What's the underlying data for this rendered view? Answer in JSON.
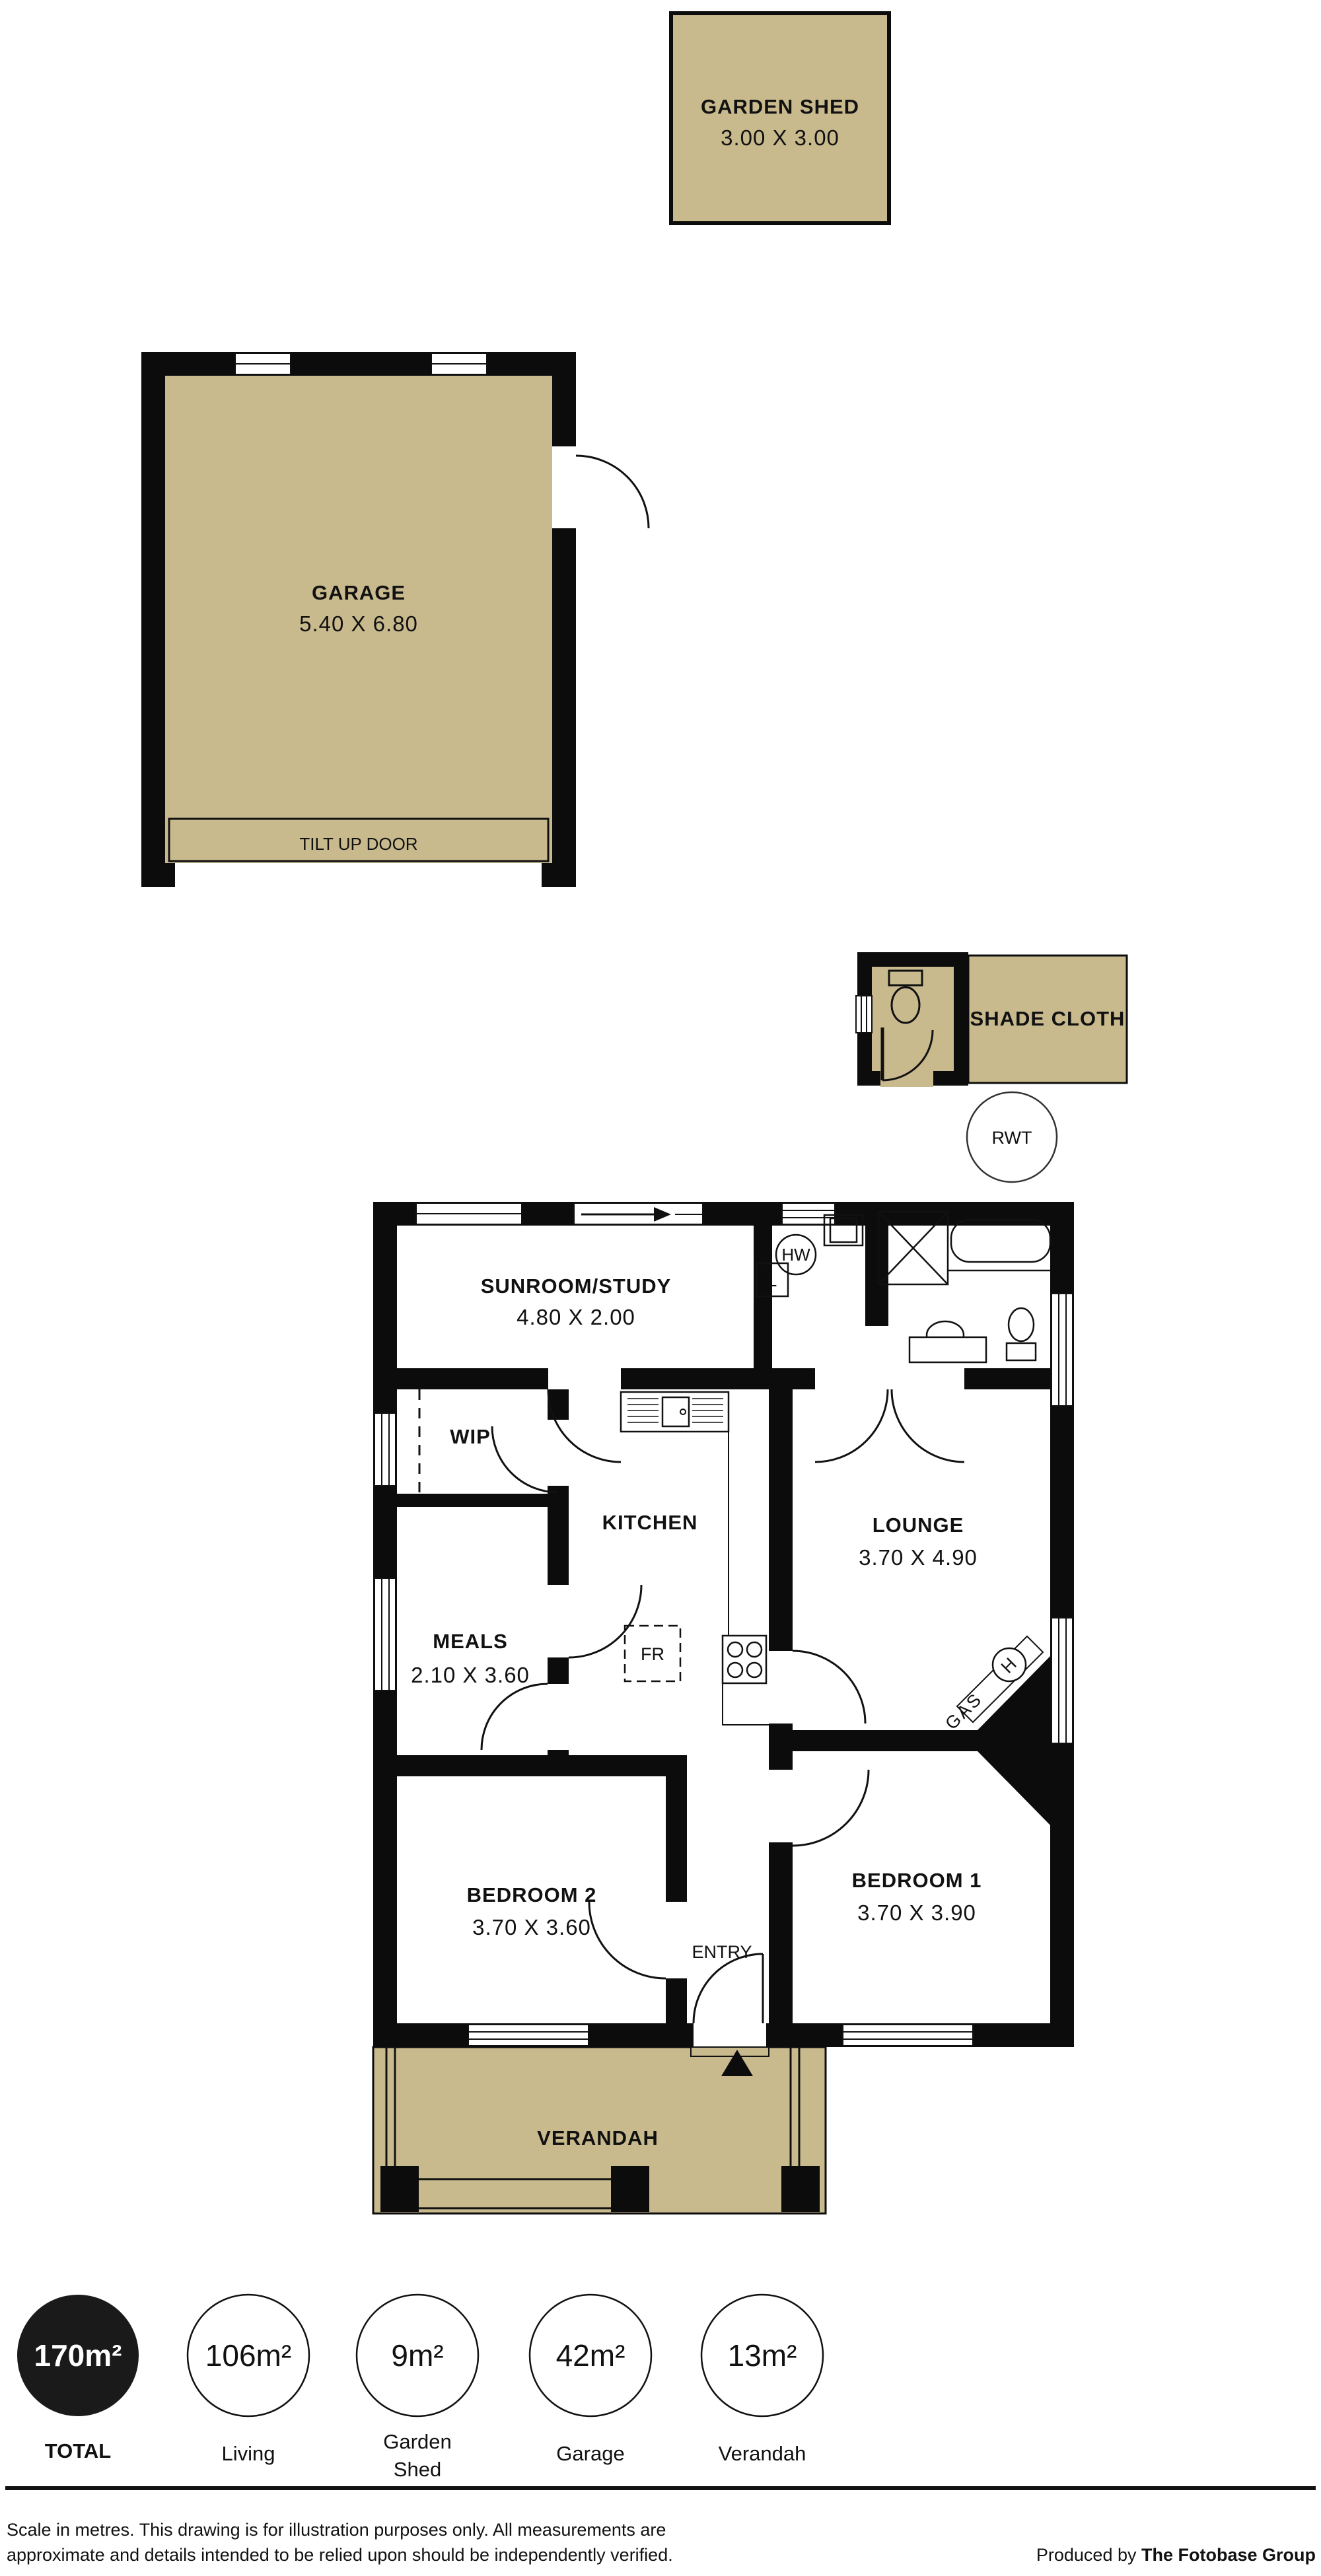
{
  "garden_shed": {
    "label": "GARDEN SHED",
    "dims": "3.00 X 3.00"
  },
  "garage": {
    "label": "GARAGE",
    "dims": "5.40 X 6.80",
    "tilt_door": "TILT UP DOOR"
  },
  "outbuilding": {
    "shade_cloth": "SHADE CLOTH",
    "rwt": "RWT"
  },
  "rooms": {
    "sunroom": {
      "label": "SUNROOM/STUDY",
      "dims": "4.80 X 2.00"
    },
    "wip": {
      "label": "WIP"
    },
    "kitchen": {
      "label": "KITCHEN"
    },
    "meals": {
      "label": "MEALS",
      "dims": "2.10 X 3.60"
    },
    "lounge": {
      "label": "LOUNGE",
      "dims": "3.70 X 4.90"
    },
    "bedroom2": {
      "label": "BEDROOM 2",
      "dims": "3.70 X 3.60"
    },
    "bedroom1": {
      "label": "BEDROOM 1",
      "dims": "3.70 X 3.90"
    },
    "entry": {
      "label": "ENTRY"
    },
    "verandah": {
      "label": "VERANDAH"
    }
  },
  "fixtures": {
    "hot_water": "HW",
    "laundry_trough": "L",
    "fridge": "FR",
    "gas": "GAS",
    "heater": "H"
  },
  "summary": [
    {
      "area": "170m²",
      "label": "TOTAL"
    },
    {
      "area": "106m²",
      "label": "Living"
    },
    {
      "area": "9m²",
      "label_line1": "Garden",
      "label_line2": "Shed"
    },
    {
      "area": "42m²",
      "label": "Garage"
    },
    {
      "area": "13m²",
      "label": "Verandah"
    }
  ],
  "footer": {
    "disclaimer_line1": "Scale in metres. This drawing is for illustration purposes only. All measurements are",
    "disclaimer_line2": "approximate and details intended to be relied upon should be independently verified.",
    "produced_by": "Produced by ",
    "producer": "The Fotobase Group"
  },
  "colors": {
    "floor_tan": "#c9ba8e",
    "wall": "#0c0c0c",
    "paper": "#ffffff"
  }
}
